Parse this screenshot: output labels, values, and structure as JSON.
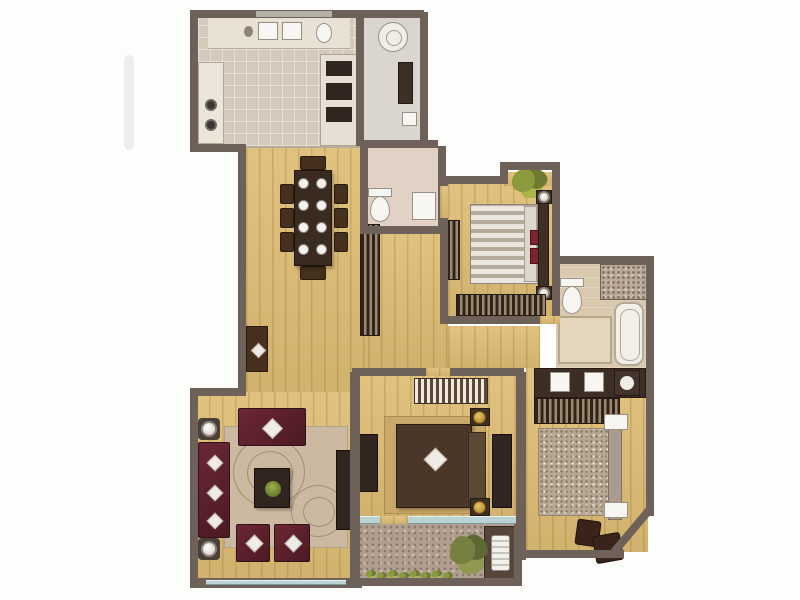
{
  "image": {
    "kind": "residential-apartment-floor-plan-render",
    "visible_text": "none",
    "background": "#fdfdfc"
  },
  "palette": {
    "wall": "#6e6159",
    "wood_floor": "#debd74",
    "kitchen_tile": "#d4c9bb",
    "utility_tile": "#dad5ce",
    "wc_tile": "#e2d1c5",
    "bath_tile": "#d9c9ae",
    "balcony_pebble": "#b09e91",
    "glass_window": "#b9d2d4",
    "sofa_maroon": "#5c2129",
    "casework_brown": "#3e2f25",
    "bed_dark_brown": "#4a372a",
    "bed_fur_beige": "#b6a893",
    "lamp_gold": "#c79a3a",
    "plant_green": "#7b8a36",
    "accent_red": "#7c2330"
  },
  "rooms": [
    {
      "id": "kitchen",
      "floor": "tile",
      "furniture": [
        "counter-with-double-sink",
        "faucet",
        "dish-basin",
        "cooktop-two-burners",
        "oven-microwave-stack"
      ]
    },
    {
      "id": "utility-bathroom",
      "floor": "tile",
      "furniture": [
        "washing-machine",
        "tall-cabinet",
        "fixture"
      ]
    },
    {
      "id": "wc",
      "floor": "tile",
      "furniture": [
        "toilet",
        "shower-tray"
      ]
    },
    {
      "id": "dining-area",
      "floor": "wood",
      "furniture": [
        "dining-table",
        "eight-place-settings",
        "eight-chairs",
        "bookshelf",
        "console-table"
      ]
    },
    {
      "id": "hallway",
      "floor": "wood",
      "furniture": [
        "storage-cabinet"
      ]
    },
    {
      "id": "bedroom-top-right",
      "floor": "wood",
      "furniture": [
        "double-bed-striped-bedding",
        "headboard",
        "two-nightstands-with-lamps",
        "red-pillows",
        "long-dresser",
        "corner-plant"
      ]
    },
    {
      "id": "ensuite-bathroom",
      "floor": "tile",
      "furniture": [
        "toilet",
        "walk-in-shower",
        "bathtub",
        "storage-cabinet"
      ]
    },
    {
      "id": "vanity-corridor",
      "floor": "wood",
      "furniture": [
        "double-sink-vanity",
        "washing-machine",
        "slatted-wardrobe"
      ]
    },
    {
      "id": "bedroom-right",
      "floor": "wood",
      "furniture": [
        "double-bed-fur-throw",
        "headboard",
        "two-white-nightstands",
        "two-ottomans"
      ]
    },
    {
      "id": "master-bedroom",
      "floor": "wood",
      "furniture": [
        "double-bed-dark-bedding",
        "diamond-pillow",
        "headboard",
        "two-nightstands-with-gold-lamps",
        "striped-dresser",
        "wardrobe",
        "media-unit",
        "area-rug",
        "red-object"
      ]
    },
    {
      "id": "living-room",
      "floor": "wood",
      "furniture": [
        "three-seat-sofa",
        "loveseat",
        "two-armchairs",
        "coffee-table-with-plant",
        "swirl-rug",
        "two-floor-lamps",
        "tv-unit"
      ]
    },
    {
      "id": "balcony",
      "floor": "pebble",
      "furniture": [
        "shrub",
        "planter-row",
        "ac-unit-niche"
      ]
    }
  ],
  "windows": [
    "kitchen-top-window",
    "living-room-bottom-window",
    "master-bedroom-balcony-window"
  ]
}
